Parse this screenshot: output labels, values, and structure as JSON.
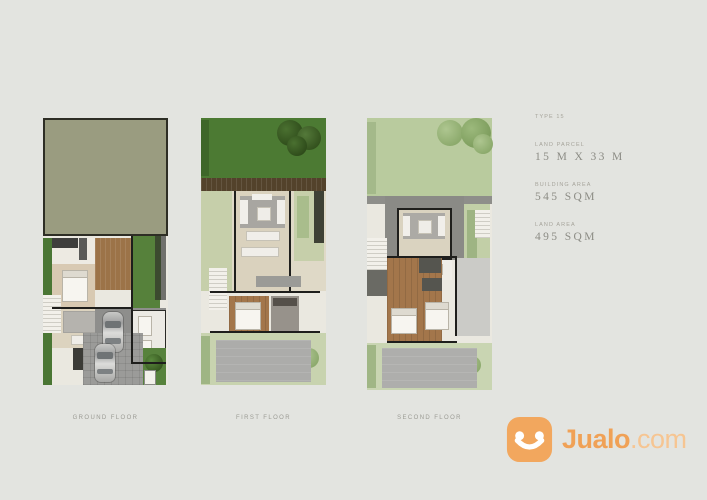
{
  "info_panel": {
    "type_label": "TYPE 15",
    "rows": [
      {
        "label": "LAND PARCEL",
        "value": "15 M X 33 M"
      },
      {
        "label": "BUILDING AREA",
        "value": "545 SQM"
      },
      {
        "label": "LAND AREA",
        "value": "495 SQM"
      }
    ]
  },
  "floor_labels": [
    {
      "label": "GROUND FLOOR"
    },
    {
      "label": "FIRST FLOOR"
    },
    {
      "label": "SECOND FLOOR"
    }
  ],
  "brand": {
    "name": "Jualo",
    "suffix": ".com",
    "icon": "jualo-smiley-icon",
    "colors": {
      "icon_orange": "#F2A75E",
      "text_orange": "#F0A156",
      "suffix_orange": "#F6C592"
    }
  },
  "palette": {
    "background": "#E3E4E0",
    "roof_olive": "#9A9C80",
    "grass_dark": "#4C7A33",
    "grass_bright": "#56813B",
    "grass_pale": "#C6CFAA",
    "garden_pale": "#B9CB9E",
    "deck_brown": "#53422B",
    "wood_floor": "#A3764B",
    "floor_beige": "#DAD2BE",
    "paving_gray": "#9B9B99",
    "roof_gray": "#ACACAA",
    "wall_black": "#1E1E1C"
  }
}
